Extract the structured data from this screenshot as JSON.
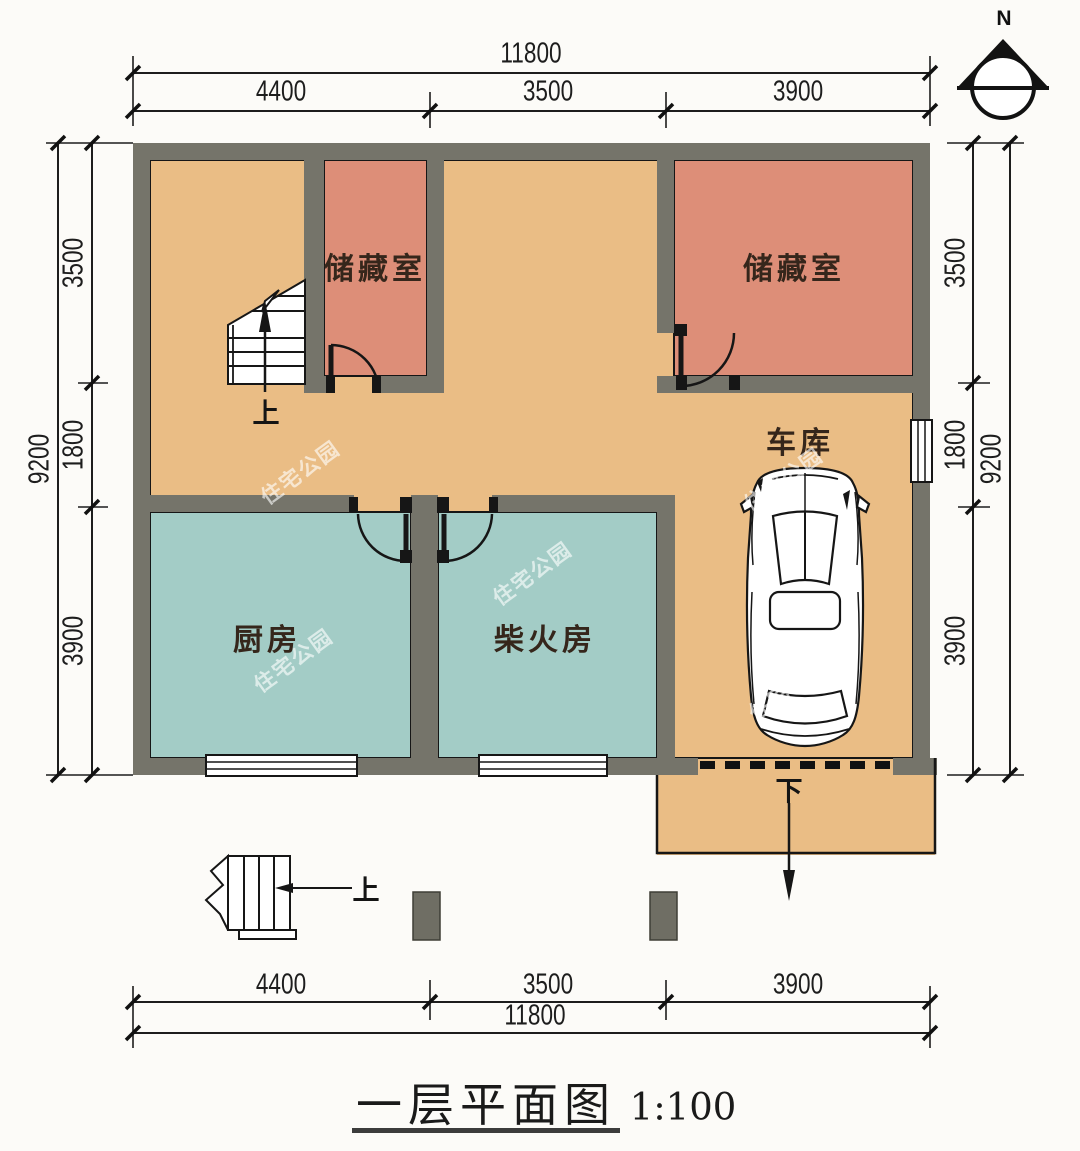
{
  "title": {
    "text": "一层平面图",
    "scale": "1:100"
  },
  "north_label": "N",
  "rooms": {
    "storage_left": "储藏室",
    "storage_right": "储藏室",
    "kitchen": "厨房",
    "firewood": "柴火房",
    "garage": "车库"
  },
  "annotations": {
    "stair_up": "上",
    "entry_up": "上",
    "garage_down": "下"
  },
  "dimensions": {
    "top": {
      "overall": "11800",
      "segments": [
        "4400",
        "3500",
        "3900"
      ]
    },
    "bottom": {
      "overall": "11800",
      "segments": [
        "4400",
        "3500",
        "3900"
      ]
    },
    "left": {
      "overall": "9200",
      "segments": [
        "3500",
        "1800",
        "3900"
      ]
    },
    "right": {
      "overall": "9200",
      "segments": [
        "3500",
        "1800",
        "3900"
      ]
    }
  },
  "watermark": "住宅公园",
  "colors": {
    "wall": "#75746a",
    "floor": "#eabd85",
    "storage": "#dd8e78",
    "utility": "#a3ccc6"
  }
}
